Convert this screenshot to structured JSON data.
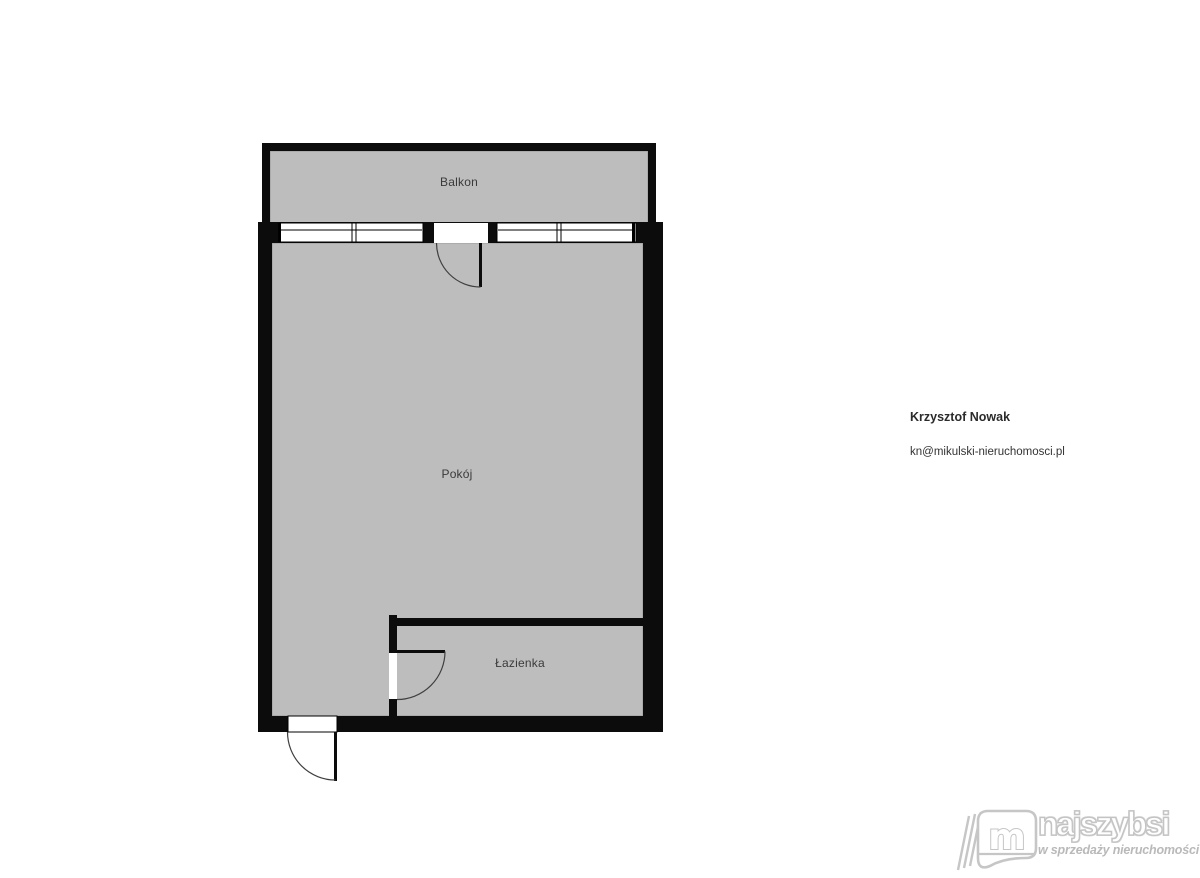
{
  "floorplan": {
    "rooms": [
      {
        "id": "balkon",
        "label": "Balkon"
      },
      {
        "id": "pokoj",
        "label": "Pokój"
      },
      {
        "id": "lazienka",
        "label": "Łazienka"
      }
    ]
  },
  "agent": {
    "name": "Krzysztof Nowak",
    "email": "kn@mikulski-nieruchomosci.pl"
  },
  "brand": {
    "name": "najszybsi",
    "tagline": "w sprzedaży nieruchomości",
    "monogram": "m"
  },
  "colors": {
    "floor_fill": "#bdbdbd",
    "wall": "#0c0c0c",
    "window_line": "#000000",
    "door_swing": "#3f3f3f",
    "label_text": "#3a3a3a",
    "watermark": "#c3c3c3"
  }
}
